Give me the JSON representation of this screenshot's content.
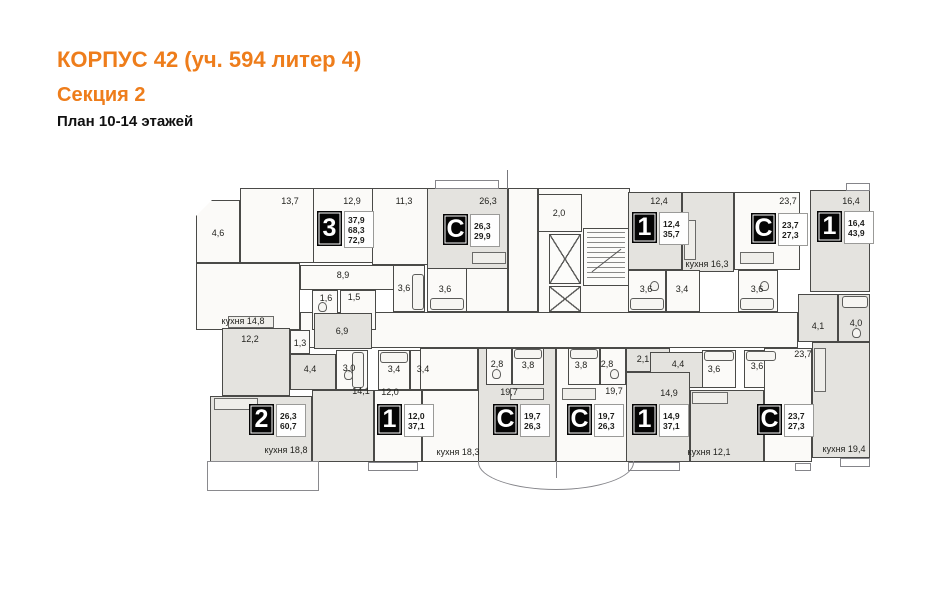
{
  "header": {
    "title": "КОРПУС 42 (уч. 594 литер 4)",
    "subtitle": "Секция 2",
    "plan_label": "План 10-14 этажей",
    "accent_color": "#ee7d1b"
  },
  "plan": {
    "colors": {
      "wall": "#4a4a48",
      "room_light": "#fbfaf8",
      "room_shaded": "#e4e3df",
      "badge_bg": "#050505"
    },
    "apartments_legend": [
      {
        "type": "3",
        "areas": [
          "37,9",
          "68,3",
          "72,9"
        ]
      },
      {
        "type": "С",
        "areas": [
          "26,3",
          "29,9"
        ]
      },
      {
        "type": "1",
        "areas": [
          "12,4",
          "35,7"
        ]
      },
      {
        "type": "С",
        "areas": [
          "23,7",
          "27,3"
        ]
      },
      {
        "type": "1",
        "areas": [
          "16,4",
          "43,9"
        ]
      },
      {
        "type": "2",
        "areas": [
          "26,3",
          "60,7"
        ]
      },
      {
        "type": "1",
        "areas": [
          "12,0",
          "37,1"
        ]
      },
      {
        "type": "С",
        "areas": [
          "19,7",
          "26,3"
        ]
      },
      {
        "type": "С",
        "areas": [
          "19,7",
          "26,3"
        ]
      },
      {
        "type": "1",
        "areas": [
          "14,9",
          "37,1"
        ]
      },
      {
        "type": "С",
        "areas": [
          "23,7",
          "27,3"
        ]
      }
    ],
    "rooms": [
      {
        "id": "balcony-4-6",
        "x": 196,
        "y": 200,
        "w": 44,
        "h": 63,
        "shade": 0,
        "clip": "polygon(0 16px,16px 0,100% 0,100% 100%,0 100%)"
      },
      {
        "id": "room-13-7",
        "x": 240,
        "y": 188,
        "w": 74,
        "h": 75,
        "shade": 0
      },
      {
        "id": "room-12-9",
        "x": 313,
        "y": 188,
        "w": 60,
        "h": 75,
        "shade": 0
      },
      {
        "id": "room-11-3",
        "x": 372,
        "y": 188,
        "w": 56,
        "h": 77,
        "shade": 0
      },
      {
        "id": "studio-a-room-26-3",
        "x": 427,
        "y": 188,
        "w": 81,
        "h": 81,
        "shade": 1
      },
      {
        "id": "studio-a-bath-3-6",
        "x": 427,
        "y": 268,
        "w": 40,
        "h": 44,
        "shade": 0
      },
      {
        "id": "studio-a-entry",
        "x": 466,
        "y": 268,
        "w": 42,
        "h": 44,
        "shade": 0
      },
      {
        "id": "entry-lobby",
        "x": 508,
        "y": 188,
        "w": 30,
        "h": 124,
        "shade": 0
      },
      {
        "id": "core-outline",
        "x": 538,
        "y": 188,
        "w": 92,
        "h": 127,
        "shade": 0
      },
      {
        "id": "vestibule-2-0",
        "x": 538,
        "y": 194,
        "w": 44,
        "h": 38,
        "shade": 0
      },
      {
        "id": "elevator-shaft-1",
        "x": 549,
        "y": 234,
        "w": 32,
        "h": 50,
        "cls": "elevator"
      },
      {
        "id": "elevator-shaft-2",
        "x": 549,
        "y": 286,
        "w": 32,
        "h": 26,
        "cls": "elevator"
      },
      {
        "id": "stairwell",
        "x": 583,
        "y": 228,
        "w": 46,
        "h": 58,
        "cls": "stairs"
      },
      {
        "id": "room-12-4",
        "x": 628,
        "y": 192,
        "w": 54,
        "h": 78,
        "shade": 1
      },
      {
        "id": "kitchen-16-3",
        "x": 682,
        "y": 192,
        "w": 52,
        "h": 80,
        "shade": 1
      },
      {
        "id": "bath-3-6-tr",
        "x": 628,
        "y": 270,
        "w": 38,
        "h": 42,
        "shade": 0
      },
      {
        "id": "hall-3-4-tr",
        "x": 666,
        "y": 270,
        "w": 34,
        "h": 42,
        "shade": 0
      },
      {
        "id": "studio-b-room-23-7",
        "x": 734,
        "y": 192,
        "w": 66,
        "h": 78,
        "shade": 0
      },
      {
        "id": "studio-b-bath-3-6",
        "x": 738,
        "y": 270,
        "w": 40,
        "h": 42,
        "shade": 0
      },
      {
        "id": "room-16-4",
        "x": 810,
        "y": 190,
        "w": 60,
        "h": 102,
        "shade": 1
      },
      {
        "id": "hall-4-1",
        "x": 798,
        "y": 294,
        "w": 40,
        "h": 48,
        "shade": 1
      },
      {
        "id": "bath-4-0",
        "x": 838,
        "y": 294,
        "w": 32,
        "h": 48,
        "shade": 1
      },
      {
        "id": "main-corridor",
        "x": 300,
        "y": 312,
        "w": 498,
        "h": 36,
        "shade": 0
      },
      {
        "id": "kitchen-14-8",
        "x": 196,
        "y": 263,
        "w": 104,
        "h": 67,
        "shade": 0
      },
      {
        "id": "hall-8-9",
        "x": 300,
        "y": 265,
        "w": 95,
        "h": 25,
        "shade": 0
      },
      {
        "id": "wc-1-6",
        "x": 312,
        "y": 290,
        "w": 26,
        "h": 40,
        "shade": 0
      },
      {
        "id": "bath-1-5",
        "x": 340,
        "y": 290,
        "w": 36,
        "h": 40,
        "shade": 0
      },
      {
        "id": "bath-3-6-tl",
        "x": 393,
        "y": 265,
        "w": 32,
        "h": 47,
        "shade": 0
      },
      {
        "id": "room-12-2",
        "x": 222,
        "y": 328,
        "w": 68,
        "h": 68,
        "shade": 1
      },
      {
        "id": "closet-1-3",
        "x": 290,
        "y": 330,
        "w": 20,
        "h": 24,
        "shade": 0
      },
      {
        "id": "hall-6-9",
        "x": 314,
        "y": 313,
        "w": 58,
        "h": 36,
        "shade": 1
      },
      {
        "id": "hall-4-4-left",
        "x": 290,
        "y": 354,
        "w": 46,
        "h": 36,
        "shade": 1
      },
      {
        "id": "bath-3-0",
        "x": 336,
        "y": 350,
        "w": 32,
        "h": 40,
        "shade": 0
      },
      {
        "id": "bath-3-4-mid",
        "x": 378,
        "y": 350,
        "w": 32,
        "h": 40,
        "shade": 0
      },
      {
        "id": "hall-3-4-right",
        "x": 410,
        "y": 350,
        "w": 32,
        "h": 40,
        "shade": 0
      },
      {
        "id": "room-14-1",
        "x": 312,
        "y": 390,
        "w": 62,
        "h": 72,
        "shade": 1
      },
      {
        "id": "room-12-0",
        "x": 374,
        "y": 390,
        "w": 48,
        "h": 72,
        "shade": 0
      },
      {
        "id": "living-kitchen-18-8",
        "x": 210,
        "y": 396,
        "w": 102,
        "h": 66,
        "shade": 1
      },
      {
        "id": "entry-kitchen-18-3",
        "x": 420,
        "y": 348,
        "w": 58,
        "h": 42,
        "shade": 0
      },
      {
        "id": "kitchen-18-3",
        "x": 422,
        "y": 390,
        "w": 70,
        "h": 72,
        "shade": 0
      },
      {
        "id": "studio-c-footprint",
        "x": 478,
        "y": 348,
        "w": 78,
        "h": 114,
        "shade": 1
      },
      {
        "id": "studio-c-bath-2-8",
        "x": 486,
        "y": 348,
        "w": 26,
        "h": 37,
        "shade": 0
      },
      {
        "id": "studio-c-bath-3-8",
        "x": 512,
        "y": 348,
        "w": 32,
        "h": 37,
        "shade": 0
      },
      {
        "id": "studio-d-footprint",
        "x": 556,
        "y": 348,
        "w": 77,
        "h": 114,
        "shade": 0
      },
      {
        "id": "studio-d-bath-3-8",
        "x": 568,
        "y": 348,
        "w": 32,
        "h": 37,
        "shade": 0
      },
      {
        "id": "studio-d-bath-2-8",
        "x": 600,
        "y": 348,
        "w": 26,
        "h": 37,
        "shade": 0
      },
      {
        "id": "hall-2-1",
        "x": 626,
        "y": 348,
        "w": 44,
        "h": 24,
        "shade": 1
      },
      {
        "id": "hall-4-4-right",
        "x": 650,
        "y": 352,
        "w": 54,
        "h": 36,
        "shade": 1
      },
      {
        "id": "bath-3-6-bl",
        "x": 702,
        "y": 350,
        "w": 34,
        "h": 38,
        "shade": 0
      },
      {
        "id": "bath-3-6-br",
        "x": 744,
        "y": 350,
        "w": 32,
        "h": 38,
        "shade": 0
      },
      {
        "id": "room-14-9",
        "x": 626,
        "y": 372,
        "w": 64,
        "h": 90,
        "shade": 1
      },
      {
        "id": "kitchen-12-1",
        "x": 690,
        "y": 390,
        "w": 74,
        "h": 72,
        "shade": 1
      },
      {
        "id": "studio-e-room-23-7",
        "x": 764,
        "y": 348,
        "w": 48,
        "h": 114,
        "shade": 0
      },
      {
        "id": "kitchen-19-4",
        "x": 812,
        "y": 342,
        "w": 58,
        "h": 116,
        "shade": 1
      }
    ],
    "labels": [
      {
        "text": "4,6",
        "x": 218,
        "y": 233
      },
      {
        "text": "13,7",
        "x": 290,
        "y": 201
      },
      {
        "text": "12,9",
        "x": 352,
        "y": 201
      },
      {
        "text": "11,3",
        "x": 404,
        "y": 201
      },
      {
        "text": "26,3",
        "x": 488,
        "y": 201
      },
      {
        "text": "2,0",
        "x": 559,
        "y": 213
      },
      {
        "text": "12,4",
        "x": 659,
        "y": 201
      },
      {
        "text": "кухня 16,3",
        "x": 707,
        "y": 264
      },
      {
        "text": "23,7",
        "x": 788,
        "y": 201
      },
      {
        "text": "16,4",
        "x": 851,
        "y": 201
      },
      {
        "text": "8,9",
        "x": 343,
        "y": 275
      },
      {
        "text": "1,6",
        "x": 326,
        "y": 298
      },
      {
        "text": "1,5",
        "x": 354,
        "y": 297
      },
      {
        "text": "3,6",
        "x": 404,
        "y": 288
      },
      {
        "text": "3,6",
        "x": 445,
        "y": 289
      },
      {
        "text": "3,6",
        "x": 646,
        "y": 289
      },
      {
        "text": "3,4",
        "x": 682,
        "y": 289
      },
      {
        "text": "3,6",
        "x": 757,
        "y": 289
      },
      {
        "text": "кухня 14,8",
        "x": 243,
        "y": 321
      },
      {
        "text": "12,2",
        "x": 250,
        "y": 339
      },
      {
        "text": "1,3",
        "x": 300,
        "y": 343
      },
      {
        "text": "6,9",
        "x": 342,
        "y": 331
      },
      {
        "text": "4,4",
        "x": 310,
        "y": 369
      },
      {
        "text": "3,0",
        "x": 349,
        "y": 368
      },
      {
        "text": "3,4",
        "x": 394,
        "y": 369
      },
      {
        "text": "3,4",
        "x": 423,
        "y": 369
      },
      {
        "text": "14,1",
        "x": 361,
        "y": 391
      },
      {
        "text": "12,0",
        "x": 390,
        "y": 392
      },
      {
        "text": "кухня 18,8",
        "x": 286,
        "y": 450
      },
      {
        "text": "кухня 18,3",
        "x": 458,
        "y": 452
      },
      {
        "text": "2,8",
        "x": 497,
        "y": 364
      },
      {
        "text": "3,8",
        "x": 528,
        "y": 365
      },
      {
        "text": "19,7",
        "x": 509,
        "y": 392
      },
      {
        "text": "3,8",
        "x": 581,
        "y": 365
      },
      {
        "text": "2,8",
        "x": 607,
        "y": 364
      },
      {
        "text": "19,7",
        "x": 614,
        "y": 391
      },
      {
        "text": "2,1",
        "x": 643,
        "y": 359
      },
      {
        "text": "4,4",
        "x": 678,
        "y": 364
      },
      {
        "text": "3,6",
        "x": 714,
        "y": 369
      },
      {
        "text": "3,6",
        "x": 757,
        "y": 366
      },
      {
        "text": "14,9",
        "x": 669,
        "y": 393
      },
      {
        "text": "кухня 12,1",
        "x": 709,
        "y": 452
      },
      {
        "text": "23,7",
        "x": 803,
        "y": 354
      },
      {
        "text": "4,1",
        "x": 818,
        "y": 326
      },
      {
        "text": "4,0",
        "x": 856,
        "y": 323
      },
      {
        "text": "кухня 19,4",
        "x": 844,
        "y": 449
      }
    ],
    "badges": [
      {
        "type": "3",
        "x": 317,
        "y": 211,
        "values": [
          "37,9",
          "68,3",
          "72,9"
        ]
      },
      {
        "type": "С",
        "x": 443,
        "y": 214,
        "values": [
          "26,3",
          "29,9"
        ]
      },
      {
        "type": "1",
        "x": 632,
        "y": 212,
        "values": [
          "12,4",
          "35,7"
        ]
      },
      {
        "type": "С",
        "x": 751,
        "y": 213,
        "values": [
          "23,7",
          "27,3"
        ]
      },
      {
        "type": "1",
        "x": 817,
        "y": 211,
        "values": [
          "16,4",
          "43,9"
        ]
      },
      {
        "type": "2",
        "x": 249,
        "y": 404,
        "values": [
          "26,3",
          "60,7"
        ]
      },
      {
        "type": "1",
        "x": 377,
        "y": 404,
        "values": [
          "12,0",
          "37,1"
        ]
      },
      {
        "type": "С",
        "x": 493,
        "y": 404,
        "values": [
          "19,7",
          "26,3"
        ]
      },
      {
        "type": "С",
        "x": 567,
        "y": 404,
        "values": [
          "19,7",
          "26,3"
        ]
      },
      {
        "type": "1",
        "x": 632,
        "y": 404,
        "values": [
          "14,9",
          "37,1"
        ]
      },
      {
        "type": "С",
        "x": 757,
        "y": 404,
        "values": [
          "23,7",
          "27,3"
        ]
      }
    ],
    "fixtures": [
      {
        "t": "tub",
        "x": 412,
        "y": 274,
        "w": 12,
        "h": 36
      },
      {
        "t": "tub",
        "x": 430,
        "y": 298,
        "w": 34,
        "h": 12
      },
      {
        "t": "tub",
        "x": 630,
        "y": 298,
        "w": 34,
        "h": 12
      },
      {
        "t": "tub",
        "x": 740,
        "y": 298,
        "w": 34,
        "h": 12
      },
      {
        "t": "tub",
        "x": 842,
        "y": 296,
        "w": 26,
        "h": 12
      },
      {
        "t": "tub",
        "x": 352,
        "y": 352,
        "w": 12,
        "h": 36
      },
      {
        "t": "tub",
        "x": 380,
        "y": 352,
        "w": 28,
        "h": 11
      },
      {
        "t": "tub",
        "x": 514,
        "y": 349,
        "w": 28,
        "h": 10
      },
      {
        "t": "tub",
        "x": 570,
        "y": 349,
        "w": 28,
        "h": 10
      },
      {
        "t": "tub",
        "x": 704,
        "y": 351,
        "w": 30,
        "h": 10
      },
      {
        "t": "tub",
        "x": 746,
        "y": 351,
        "w": 30,
        "h": 10
      },
      {
        "t": "wc",
        "x": 318,
        "y": 302,
        "w": 9,
        "h": 10
      },
      {
        "t": "wc",
        "x": 344,
        "y": 370,
        "w": 9,
        "h": 10
      },
      {
        "t": "wc",
        "x": 492,
        "y": 369,
        "w": 9,
        "h": 10
      },
      {
        "t": "wc",
        "x": 610,
        "y": 369,
        "w": 9,
        "h": 10
      },
      {
        "t": "wc",
        "x": 650,
        "y": 281,
        "w": 9,
        "h": 10
      },
      {
        "t": "wc",
        "x": 760,
        "y": 281,
        "w": 9,
        "h": 10
      },
      {
        "t": "wc",
        "x": 852,
        "y": 328,
        "w": 9,
        "h": 10
      },
      {
        "t": "counter",
        "x": 228,
        "y": 316,
        "w": 46,
        "h": 12
      },
      {
        "t": "counter",
        "x": 684,
        "y": 220,
        "w": 12,
        "h": 40
      },
      {
        "t": "counter",
        "x": 814,
        "y": 348,
        "w": 12,
        "h": 44
      },
      {
        "t": "counter",
        "x": 214,
        "y": 398,
        "w": 44,
        "h": 12
      },
      {
        "t": "counter",
        "x": 472,
        "y": 252,
        "w": 34,
        "h": 12
      },
      {
        "t": "counter",
        "x": 740,
        "y": 252,
        "w": 34,
        "h": 12
      },
      {
        "t": "counter",
        "x": 510,
        "y": 388,
        "w": 34,
        "h": 12
      },
      {
        "t": "counter",
        "x": 562,
        "y": 388,
        "w": 34,
        "h": 12
      },
      {
        "t": "counter",
        "x": 692,
        "y": 392,
        "w": 36,
        "h": 12
      }
    ],
    "slabs": [
      {
        "x": 435,
        "y": 180,
        "w": 64,
        "h": 9
      },
      {
        "x": 846,
        "y": 183,
        "w": 24,
        "h": 8
      },
      {
        "x": 368,
        "y": 462,
        "w": 50,
        "h": 9
      },
      {
        "x": 628,
        "y": 462,
        "w": 52,
        "h": 9
      },
      {
        "x": 795,
        "y": 463,
        "w": 16,
        "h": 8
      },
      {
        "x": 840,
        "y": 458,
        "w": 30,
        "h": 9
      },
      {
        "x": 207,
        "y": 461,
        "w": 112,
        "h": 30,
        "cls": "terrace"
      },
      {
        "x": 478,
        "y": 461,
        "w": 156,
        "h": 29,
        "cls": "curved"
      },
      {
        "x": 507,
        "y": 170,
        "w": 1,
        "h": 19,
        "cls": "line"
      }
    ]
  }
}
